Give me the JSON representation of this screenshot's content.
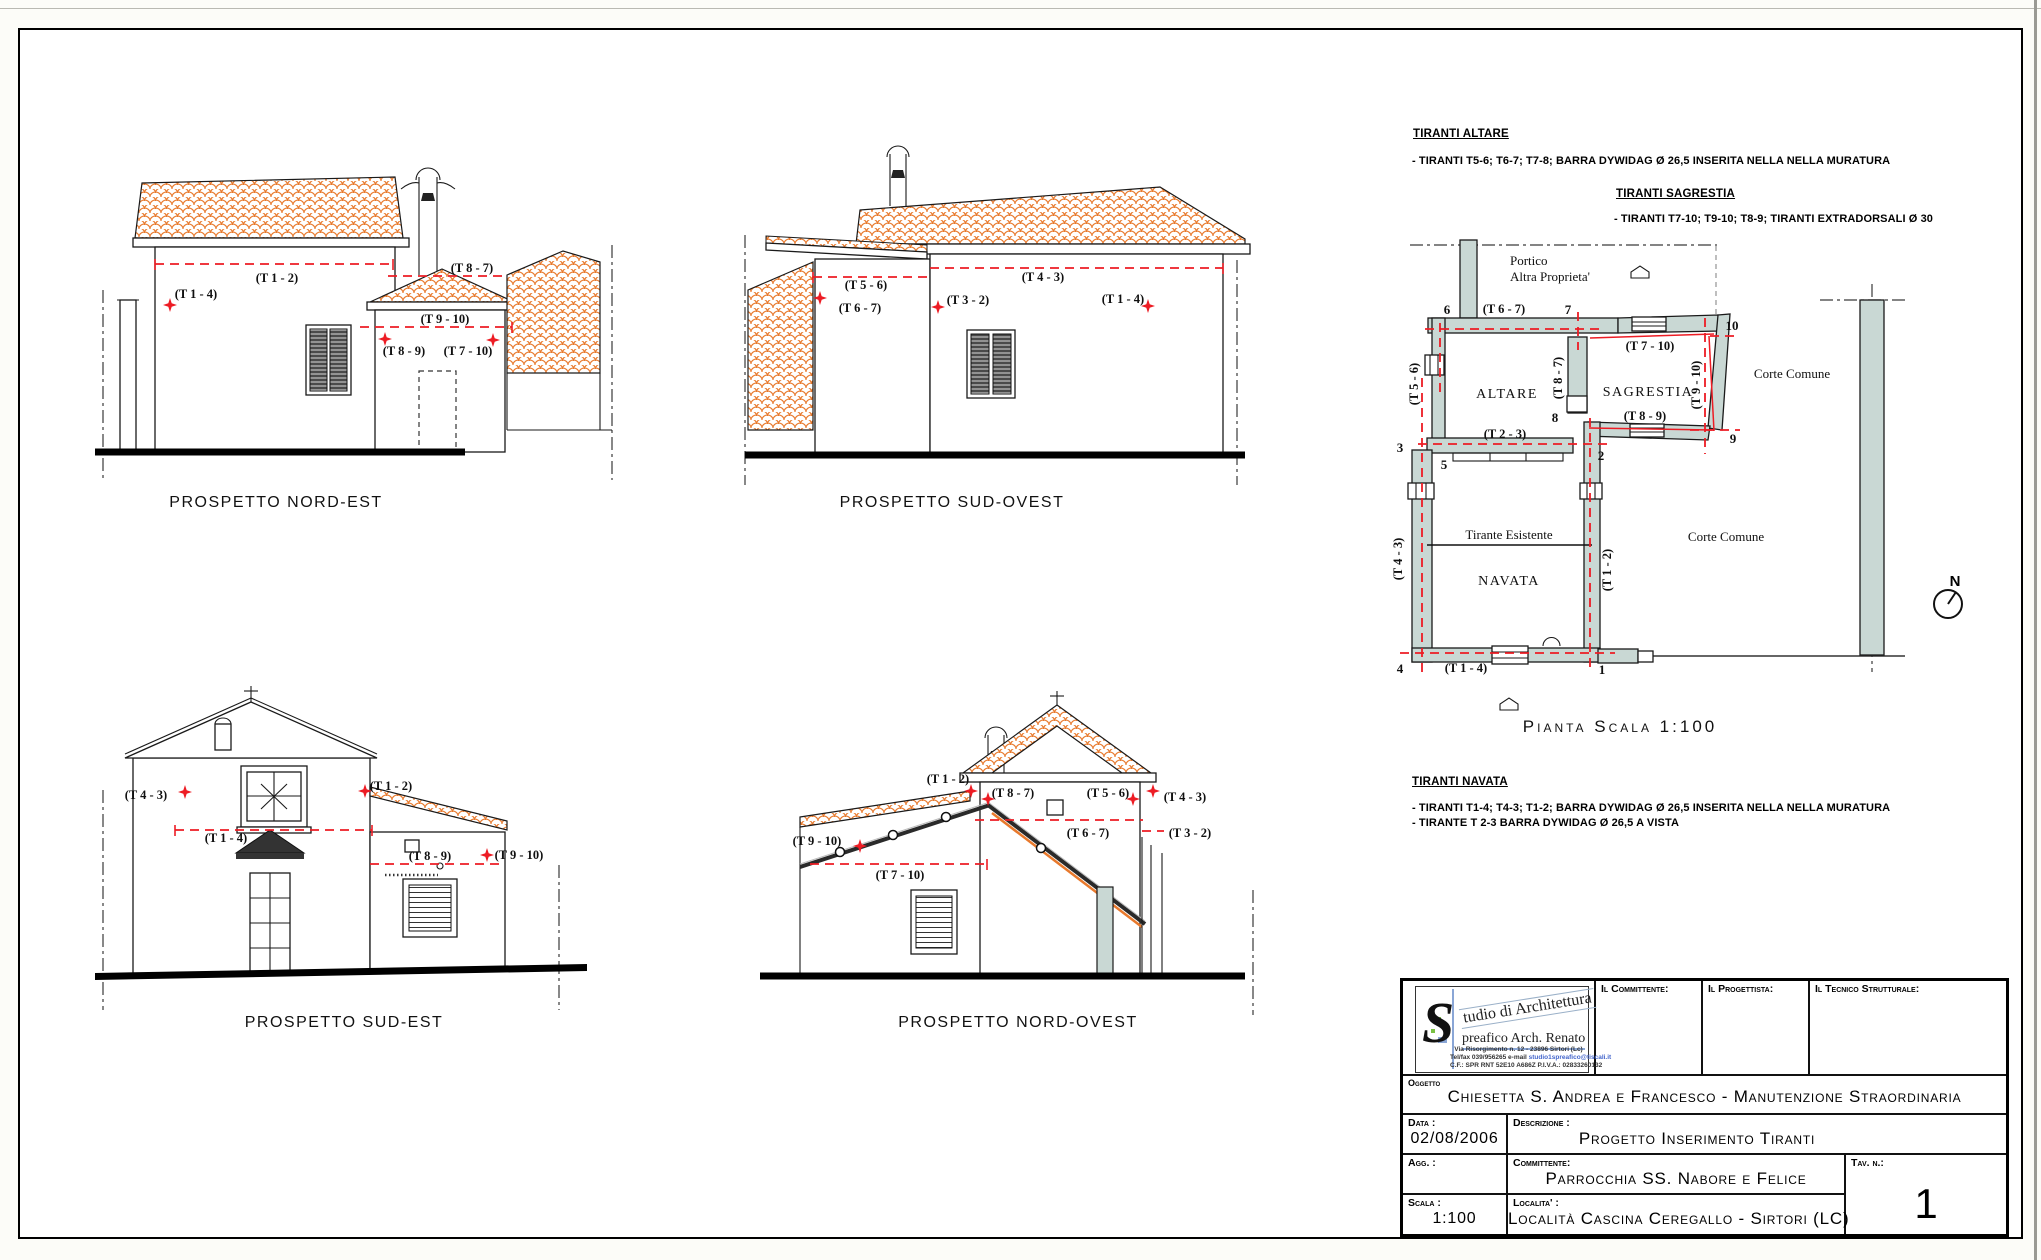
{
  "labels": {
    "t12": "(T 1 - 2)",
    "t14": "(T 1 - 4)",
    "t23": "(T 2 - 3)",
    "t32": "(T 3 - 2)",
    "t43": "(T 4 - 3)",
    "t56": "(T 5 - 6)",
    "t67": "(T 6 - 7)",
    "t710": "(T 7 - 10)",
    "t87": "(T 8 - 7)",
    "t89": "(T 8 - 9)",
    "t910": "(T 9 - 10)"
  },
  "elevations": {
    "nord_est": "PROSPETTO NORD-EST",
    "sud_ovest": "PROSPETTO SUD-OVEST",
    "sud_est": "PROSPETTO SUD-EST",
    "nord_ovest": "PROSPETTO NORD-OVEST"
  },
  "notes": {
    "altare_title": "TIRANTI ALTARE",
    "altare_line": "- TIRANTI  T5-6;  T6-7;  T7-8; BARRA DYWIDAG Ø 26,5 INSERITA NELLA NELLA MURATURA",
    "sagrestia_title": "TIRANTI SAGRESTIA",
    "sagrestia_line": "- TIRANTI  T7-10;  T9-10;  T8-9; TIRANTI EXTRADORSALI Ø 30",
    "navata_title": "TIRANTI NAVATA",
    "navata_line1": "- TIRANTI  T1-4;  T4-3;  T1-2; BARRA DYWIDAG Ø 26,5 INSERITA NELLA NELLA MURATURA",
    "navata_line2": "- TIRANTE T 2-3 BARRA DYWIDAG Ø 26,5 A VISTA"
  },
  "plan": {
    "caption": "Pianta   Scala   1:100",
    "rooms": {
      "altare": "ALTARE",
      "sagrestia": "SAGRESTIA",
      "navata": "NAVATA"
    },
    "ann": {
      "portico": "Portico",
      "altra_proprieta": "Altra Proprieta'",
      "corte_comune": "Corte Comune",
      "tirante_esistente": "Tirante Esistente",
      "north": "N"
    },
    "nodes": {
      "n1": "1",
      "n2": "2",
      "n3": "3",
      "n4": "4",
      "n5": "5",
      "n6": "6",
      "n7": "7",
      "n8": "8",
      "n9": "9",
      "n10": "10"
    }
  },
  "titleblock": {
    "logo": {
      "initial": "S",
      "studio": "tudio di Architettura",
      "name": "preafico Arch. Renato",
      "address": "Via Risorgimento n. 12 - 23896 Sirtori (Lc)",
      "contacts_pre": "Tel/fax 039/956265  e-mail ",
      "email": "studio1spreafico@tiscali.it",
      "fiscal": "C.F.: SPR RNT 52E10 A686Z     P.I.V.A.: 02833260132"
    },
    "committente_label": "Il Committente:",
    "progettista_label": "Il Progettista:",
    "tecnico_label": "Il Tecnico Strutturale:",
    "oggetto_label": "Oggetto",
    "oggetto": "Chiesetta S. Andrea e Francesco - Manutenzione Straordinaria",
    "data_label": "Data :",
    "data": "02/08/2006",
    "descrizione_label": "Descrizione :",
    "descrizione": "Progetto Inserimento Tiranti",
    "agg_label": "Agg. :",
    "committente2_label": "Committente:",
    "committente2": "Parrocchia SS. Nabore e Felice",
    "tav_label": "Tav. n.:",
    "tav": "1",
    "scala_label": "Scala :",
    "localita_label": "Localita' :",
    "scala": "1:100",
    "localita": "Località Cascina Ceregallo - Sirtori (LC)"
  },
  "colors": {
    "red": "#ed1c24",
    "wall_fill": "#c9d8d4",
    "tile": "#e8792c"
  }
}
